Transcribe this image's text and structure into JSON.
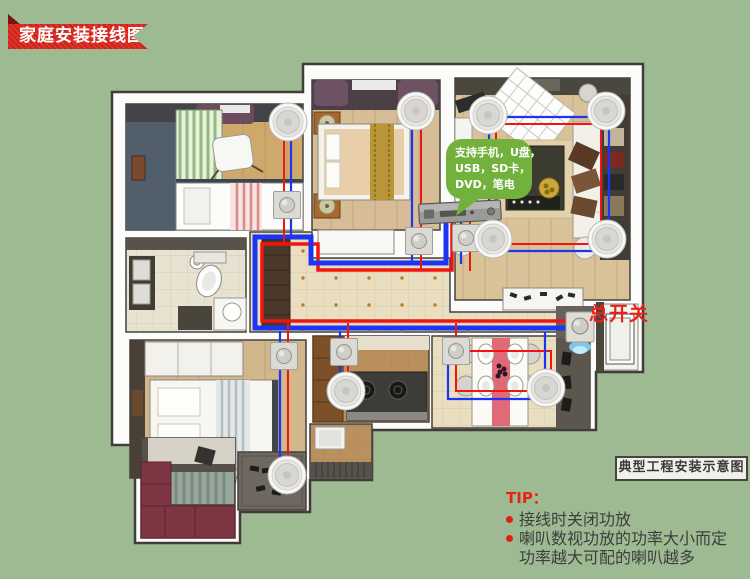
{
  "banner": {
    "title": "家庭安装接线图"
  },
  "floor_plan": {
    "bubble_lines": [
      "支持手机，U盘，",
      "USB，SD卡，",
      "DVD，笔电"
    ],
    "main_switch_label": "总开关",
    "caption": "典型工程安装示意图"
  },
  "tips": {
    "heading": "TIP：",
    "items": [
      "接线时关闭功放",
      "喇叭数视功放的功率大小而定",
      "功率越大可配的喇叭越多"
    ]
  },
  "colors": {
    "background_green": "#9dba93",
    "wire_blue": "#1b35f2",
    "wire_red": "#f01510",
    "accent_red": "#e8221a",
    "bubble_green": "#72b23c",
    "ribbon_red": "#e02920"
  },
  "icons": {
    "ceiling_speaker": "round-grille-speaker",
    "volume_control": "square-knob-panel",
    "main_switch": "square-knob-panel",
    "amplifier": "rack-unit"
  }
}
